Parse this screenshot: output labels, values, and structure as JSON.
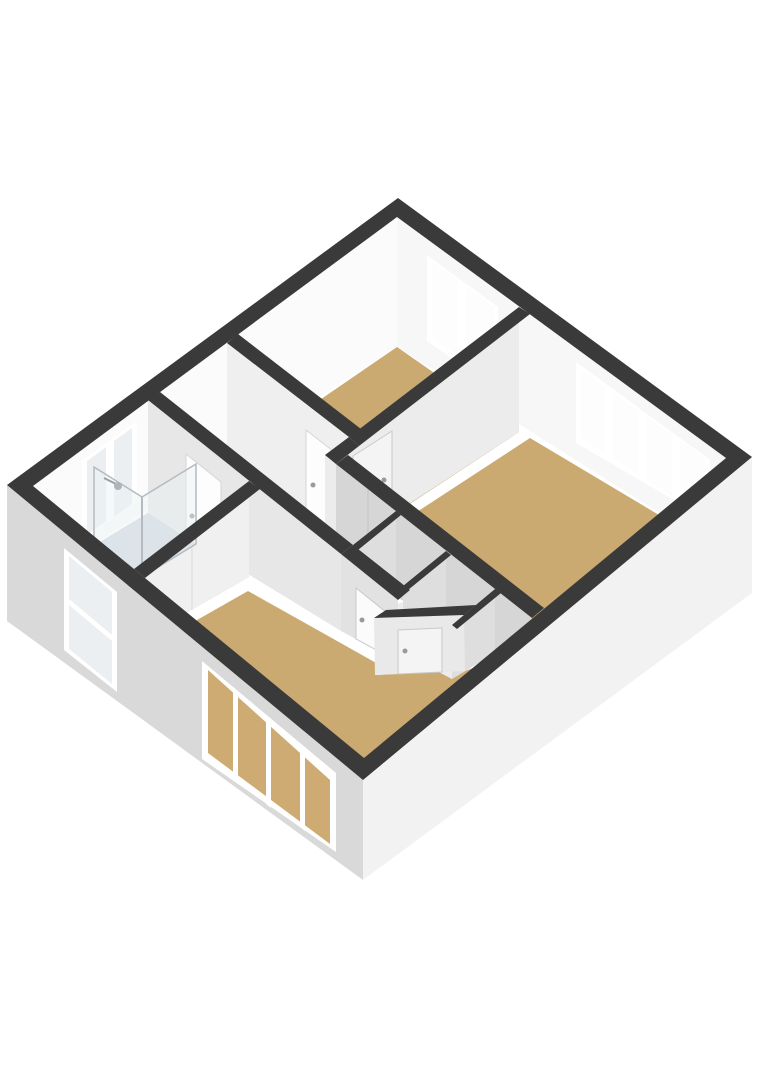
{
  "scene": {
    "kind": "3d-floorplan-render",
    "view": "isometric-top-down",
    "background": "#ffffff",
    "rooms": [
      {
        "id": "bedroom-top",
        "floor": "tan"
      },
      {
        "id": "bedroom-right",
        "floor": "tan"
      },
      {
        "id": "bedroom-bottom",
        "floor": "tan"
      },
      {
        "id": "bathroom",
        "floor": "blue-grey"
      },
      {
        "id": "landing",
        "floor": "tan"
      },
      {
        "id": "closet-a",
        "floor": "white"
      },
      {
        "id": "closet-b",
        "floor": "white"
      }
    ],
    "features": [
      "stairwell-opening",
      "stairs",
      "shower-enclosure",
      "shower-head",
      "interior-doors",
      "windows-ne-facade",
      "window-nw-facade",
      "windows-sw-facade-exterior"
    ]
  },
  "colors": {
    "background": "#ffffff",
    "wall_top": "#3a3a3a",
    "floor_tan": "#cbaa72",
    "floor_tan_deep": "#c5a468",
    "floor_bath": "#c3cdd6",
    "shower_tray": "#cfd8e0",
    "facade_sw": "#d9d9d9",
    "facade_se": "#f2f2f2",
    "face_ne_interior": "#f7f7f7",
    "face_nw_interior": "#fbfbfb",
    "face_bright": "#efefef",
    "face_light": "#ececec",
    "face_mid": "#dedede",
    "face_dim": "#d6d6d6",
    "face_soft": "#e7e7e7",
    "face_soft2": "#e2e2e2",
    "face_cham": "#e9e9e9",
    "face_bathwall": "#f0f0f0",
    "cell_floor": "#ececec",
    "window_frame": "#ffffff",
    "pane_bright": "#fdfdfd",
    "pane_cool": "#eceff1",
    "pane_tan": "#cdab72",
    "door_white": "#fbfbfb",
    "door_bright": "#fdfdfd",
    "door_soft": "#f4f4f4",
    "door_stroke": "#c9c9c9",
    "handle": "#9a9a9a",
    "stair_hole": "#1a1a1a",
    "tread_a": "#f5f5f5",
    "tread_b": "#e3e3e3",
    "glass": "rgba(236,241,244,0.45)",
    "glass_frame": "#b4bac0",
    "seam": "rgba(0,0,0,0.06)"
  }
}
